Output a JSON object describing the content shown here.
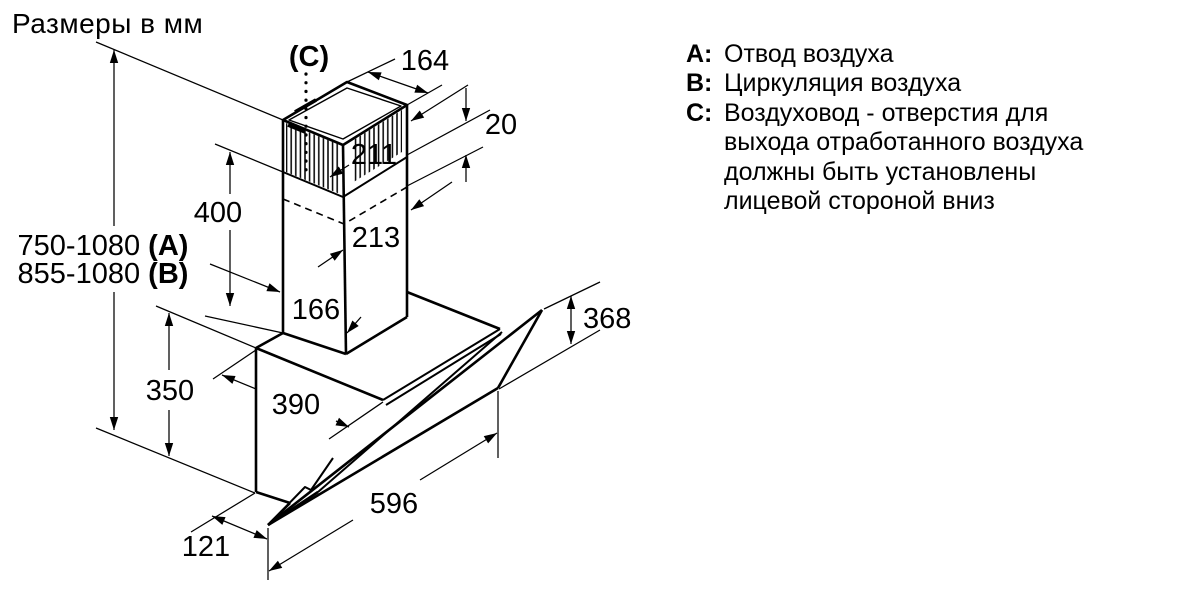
{
  "title": "Размеры в мм",
  "legend": {
    "items": [
      {
        "key": "A:",
        "lines": [
          "Отвод воздуха"
        ]
      },
      {
        "key": "B:",
        "lines": [
          "Циркуляция воздуха"
        ]
      },
      {
        "key": "C:",
        "lines": [
          "Воздуховод - отверстия для",
          "выхода отработанного воздуха",
          "должны быть установлены",
          "лицевой стороной вниз"
        ]
      }
    ]
  },
  "dims": {
    "top_opening_width": "164",
    "vent_strip_offset": "20",
    "upper_chimney_width": "211",
    "chimney_section_height": "400",
    "lower_chimney_width": "213",
    "chimney_base_width": "166",
    "mount_height_exhaust": "750-1080 ",
    "mount_height_exhaust_mode": "(A)",
    "mount_height_recirc": "855-1080 ",
    "mount_height_recirc_mode": "(B)",
    "body_height": "350",
    "body_depth": "390",
    "panel_height": "368",
    "hood_width": "596",
    "bottom_clearance": "121",
    "duct_pointer_label": "(C)"
  },
  "colors": {
    "line": "#000000",
    "background": "#ffffff"
  }
}
